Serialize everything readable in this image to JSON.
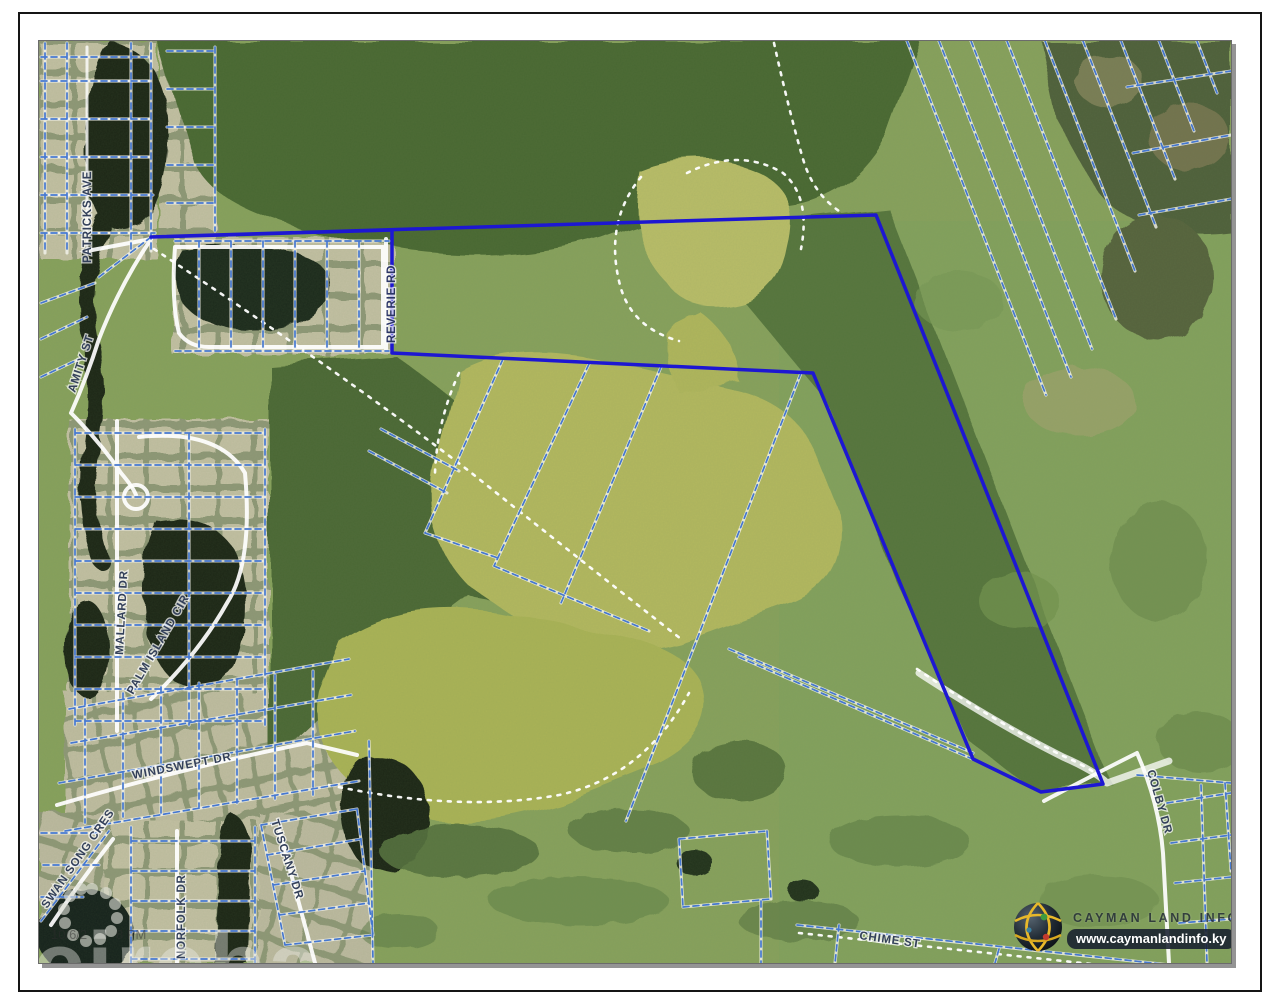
{
  "map": {
    "streets": {
      "patricks_ave": "PATRICKS AVE",
      "amity_st": "AMITY ST",
      "reverie_rd": "REVERIE RD",
      "mallard_dr": "MALLARD DR",
      "palm_island_cir": "PALM ISLAND CIR",
      "windswept_dr": "WINDSWEPT DR",
      "swan_song_cres": "SWAN SONG CRES",
      "norfolk_dr": "NORFOLK DR",
      "tuscany_dr": "TUSCANY DR",
      "chime_st": "CHIME ST",
      "colby_dr": "COLBY DR"
    },
    "branding": {
      "name": "CAYMAN LAND INFO",
      "url": "www.caymanlandinfo.ky"
    },
    "watermark": {
      "agency": "cireba",
      "timestamp_fragment": "10/6/2        8 PM"
    },
    "colors": {
      "parcel_outline": "#1d17d2",
      "cadastral_line": "#3d72cf",
      "road": "#ffffff",
      "forest_dark": "#4a6733",
      "scrub_green": "#83a15d",
      "pond_olive": "#b3b85e",
      "water_dark": "#1b2619",
      "sand": "#ded8b4"
    }
  }
}
